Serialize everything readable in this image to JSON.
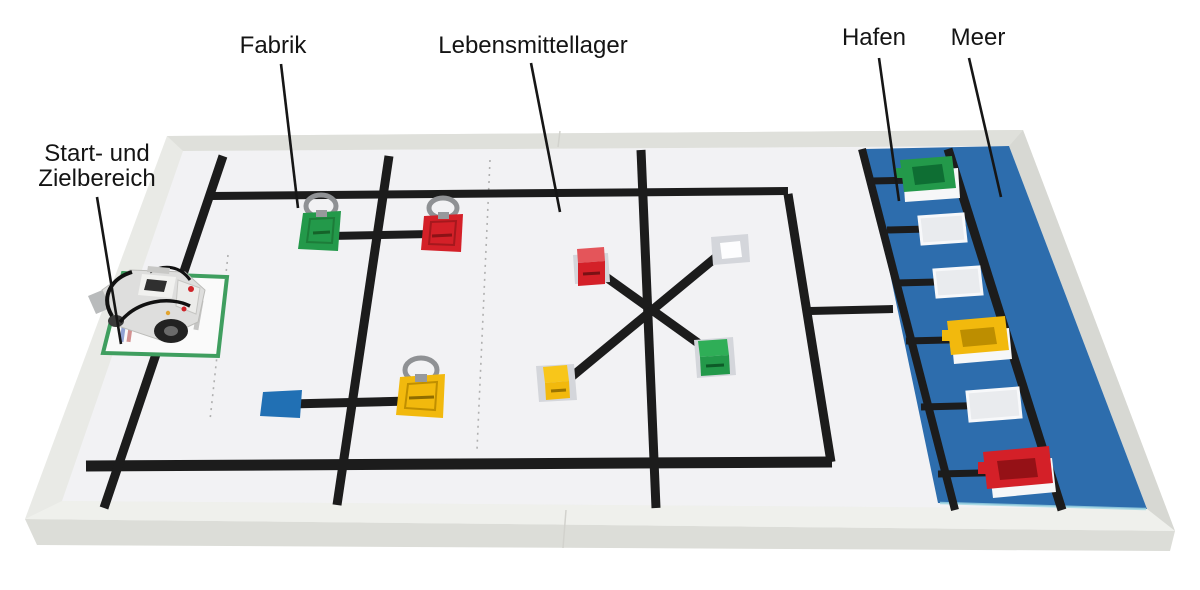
{
  "labels": {
    "factory": "Fabrik",
    "food_storage": "Lebensmittellager",
    "harbor": "Hafen",
    "sea": "Meer",
    "start_area_line1": "Start- und",
    "start_area_line2": "Zielbereich"
  },
  "colors": {
    "label_text": "#141414",
    "leader": "#161616",
    "tape": "#1c1c1c",
    "dashed": "#b0b0b0",
    "board": "#f2f2f4",
    "rim": "#e9eae6",
    "rim_wall_top": "#dfe0db",
    "rim_wall_right": "#d7d8d3",
    "rim_wall_bottom": "#eff0ec",
    "rim_front": "#dcddd8",
    "sea": "#2d6dad",
    "sea_edge": "#9fd8e4",
    "blue_square": "#2170b4",
    "green": "#23994a",
    "green_light": "#2fae57",
    "green_dark": "#0e6e33",
    "red": "#d42028",
    "red_light": "#e4555a",
    "red_dark": "#951116",
    "yellow": "#f2b90d",
    "yellow_light": "#f8c61a",
    "yellow_dark": "#bd8e00",
    "marker": "#d4d6db",
    "marker_hole": "#fdfdfe",
    "dock": "#e9ebee",
    "dock_edge": "#f7f8fa",
    "ring": "#8f9194",
    "start_outline": "#3f9e5f",
    "mat": "#fafafa",
    "robot_body": "#dededd",
    "robot_dark": "#2f2f2f",
    "cable": "#111111"
  }
}
